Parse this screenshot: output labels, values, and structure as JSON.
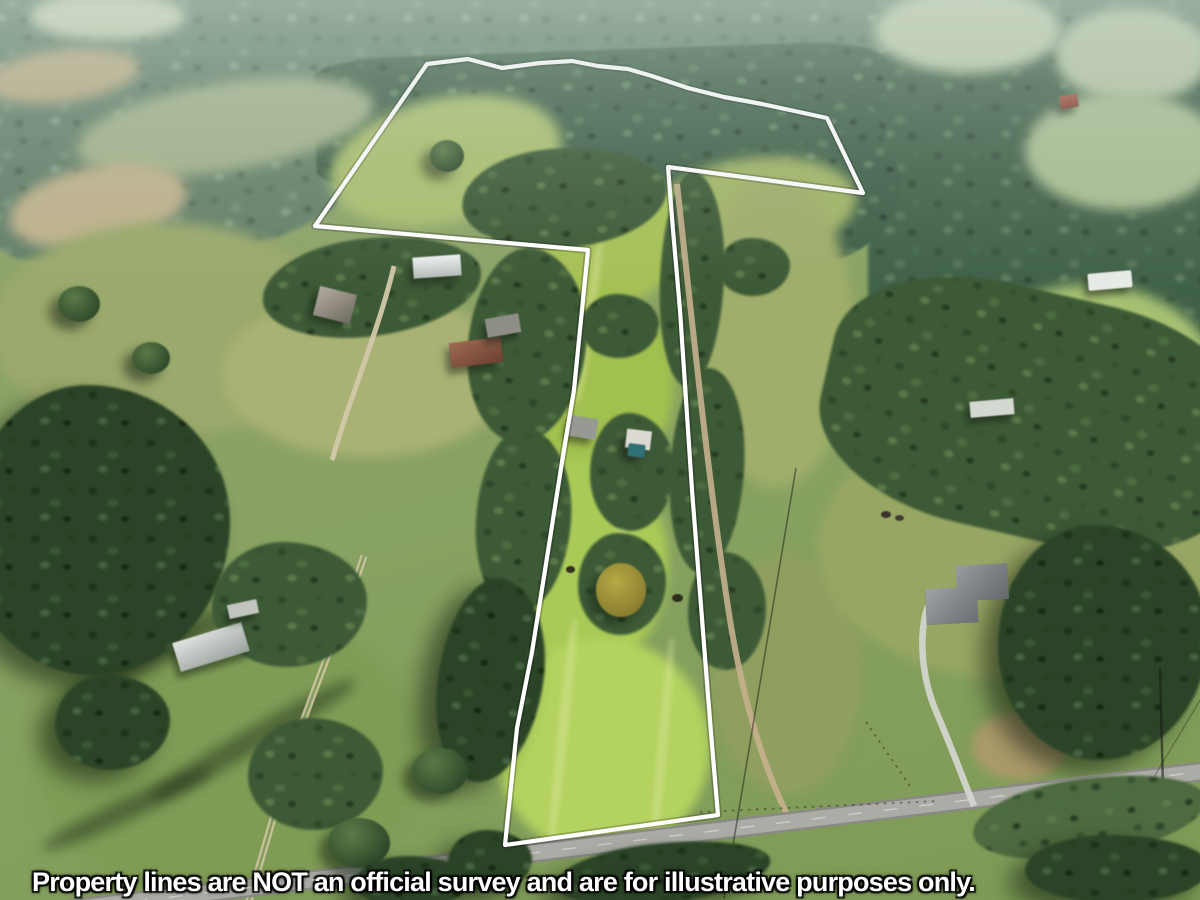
{
  "photo": {
    "kind": "aerial-drone-photograph",
    "subject": "rural acreage real-estate listing with outlined parcel"
  },
  "overlay": {
    "disclaimer_text": "Property lines are NOT an official survey and are for illustrative purposes only.",
    "text_color": "#ffffff",
    "text_outline_color": "#000000",
    "boundary_stroke_color": "#ffffff",
    "boundary_points": "427,64 468,59 502,68 540,63 572,61 598,66 628,69 652,76 688,88 724,97 762,104 827,118 863,193 668,167 673,230 680,310 686,400 692,490 699,580 706,670 712,745 718,815 505,845 517,728 532,652 549,545 562,462 574,390 588,250 315,226"
  }
}
